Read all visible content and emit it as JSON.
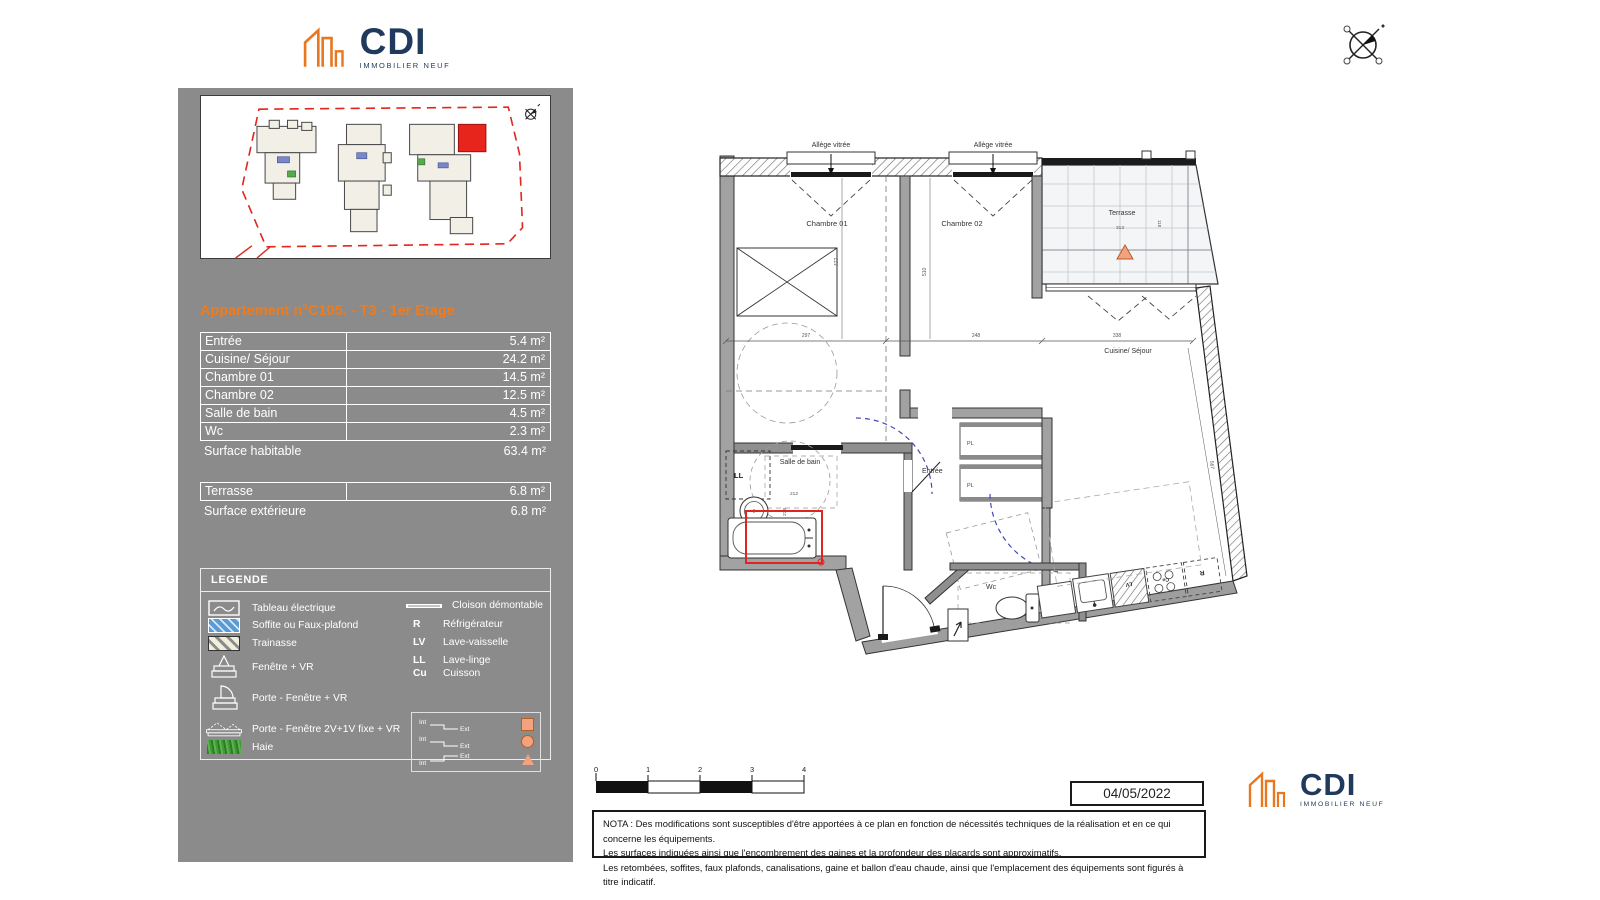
{
  "brand": {
    "name": "CDI",
    "tagline": "IMMOBILIER NEUF"
  },
  "colors": {
    "panel_gray": "#8b8b8b",
    "accent_orange": "#ee7b1d",
    "brand_navy": "#1f3a5c",
    "brand_orange": "#e87722",
    "highlight_red": "#e02424",
    "soffite_blue": "#5b9bd5",
    "haie_green": "#3f9b35",
    "arc_blue": "#4646b4",
    "marker_salmon": "#f2a27c"
  },
  "sidebar": {
    "title": "Appartement n°C105. - T3 - 1er Etage",
    "table": {
      "rows": [
        {
          "label": "Entrée",
          "area": "5.4 m²"
        },
        {
          "label": "Cuisine/ Séjour",
          "area": "24.2 m²"
        },
        {
          "label": "Chambre 01",
          "area": "14.5 m²"
        },
        {
          "label": "Chambre 02",
          "area": "12.5 m²"
        },
        {
          "label": "Salle de bain",
          "area": "4.5 m²"
        },
        {
          "label": "Wc",
          "area": "2.3 m²"
        }
      ],
      "total": {
        "label": "Surface habitable",
        "area": "63.4 m²"
      }
    },
    "exterior": {
      "rows": [
        {
          "label": "Terrasse",
          "area": "6.8 m²"
        }
      ],
      "total": {
        "label": "Surface extérieure",
        "area": "6.8 m²"
      }
    },
    "legend": {
      "title": "LEGENDE",
      "items_left": [
        {
          "icon": "electrical-panel-icon",
          "label": "Tableau électrique"
        },
        {
          "icon": "soffit-icon",
          "label": "Soffite ou Faux-plafond"
        },
        {
          "icon": "trainasse-icon",
          "label": "Trainasse"
        },
        {
          "icon": "window-vr-icon",
          "label": "Fenêtre + VR"
        },
        {
          "icon": "door-window-vr-icon",
          "label": "Porte - Fenêtre + VR"
        },
        {
          "icon": "door-window-2v1v-icon",
          "label": "Porte - Fenêtre 2V+1V fixe + VR"
        },
        {
          "icon": "hedge-icon",
          "label": "Haie"
        }
      ],
      "items_right": [
        {
          "abbr": "",
          "label": "Cloison démontable",
          "icon": "partition-line-icon"
        },
        {
          "abbr": "R",
          "label": "Réfrigérateur"
        },
        {
          "abbr": "LV",
          "label": "Lave-vaisselle"
        },
        {
          "abbr": "LL",
          "label": "Lave-linge"
        },
        {
          "abbr": "Cu",
          "label": "Cuisson"
        }
      ],
      "int_ext": {
        "int": "Int",
        "ext": "Ext"
      }
    }
  },
  "plan": {
    "labels": {
      "allege": "Allège vitrée",
      "chambre01": "Chambre 01",
      "chambre02": "Chambre 02",
      "terrasse": "Terrasse",
      "cuisine_sejour": "Cuisine/ Séjour",
      "salle_de_bain": "Salle de bain",
      "entree": "Entrée",
      "wc": "Wc",
      "ll": "LL",
      "pl": "PL",
      "cu": "Cu",
      "r": "R",
      "lv": "LV"
    },
    "dims": {
      "chambre01_width": "297",
      "chambre01_depth": "477",
      "chambre02_depth": "510",
      "chambre02_width": "248",
      "sejour_width": "338",
      "sejour_depth": "567",
      "terrasse_width": "313",
      "terrasse_depth": "118",
      "sdb_width": "212",
      "sdb_depth": "228"
    }
  },
  "footer": {
    "scale_ticks": [
      "0",
      "1",
      "2",
      "3",
      "4"
    ],
    "date": "04/05/2022",
    "nota": [
      "NOTA : Des modifications sont susceptibles d'être apportées à ce plan en fonction de nécessités techniques de la réalisation et en ce qui concerne les équipements.",
      "Les surfaces indiquées ainsi que l'encombrement des gaines et la profondeur des placards sont approximatifs.",
      "Les retombées, soffites, faux plafonds, canalisations, gaine et ballon d'eau chaude, ainsi que l'emplacement des équipements sont figurés à titre indicatif."
    ]
  }
}
